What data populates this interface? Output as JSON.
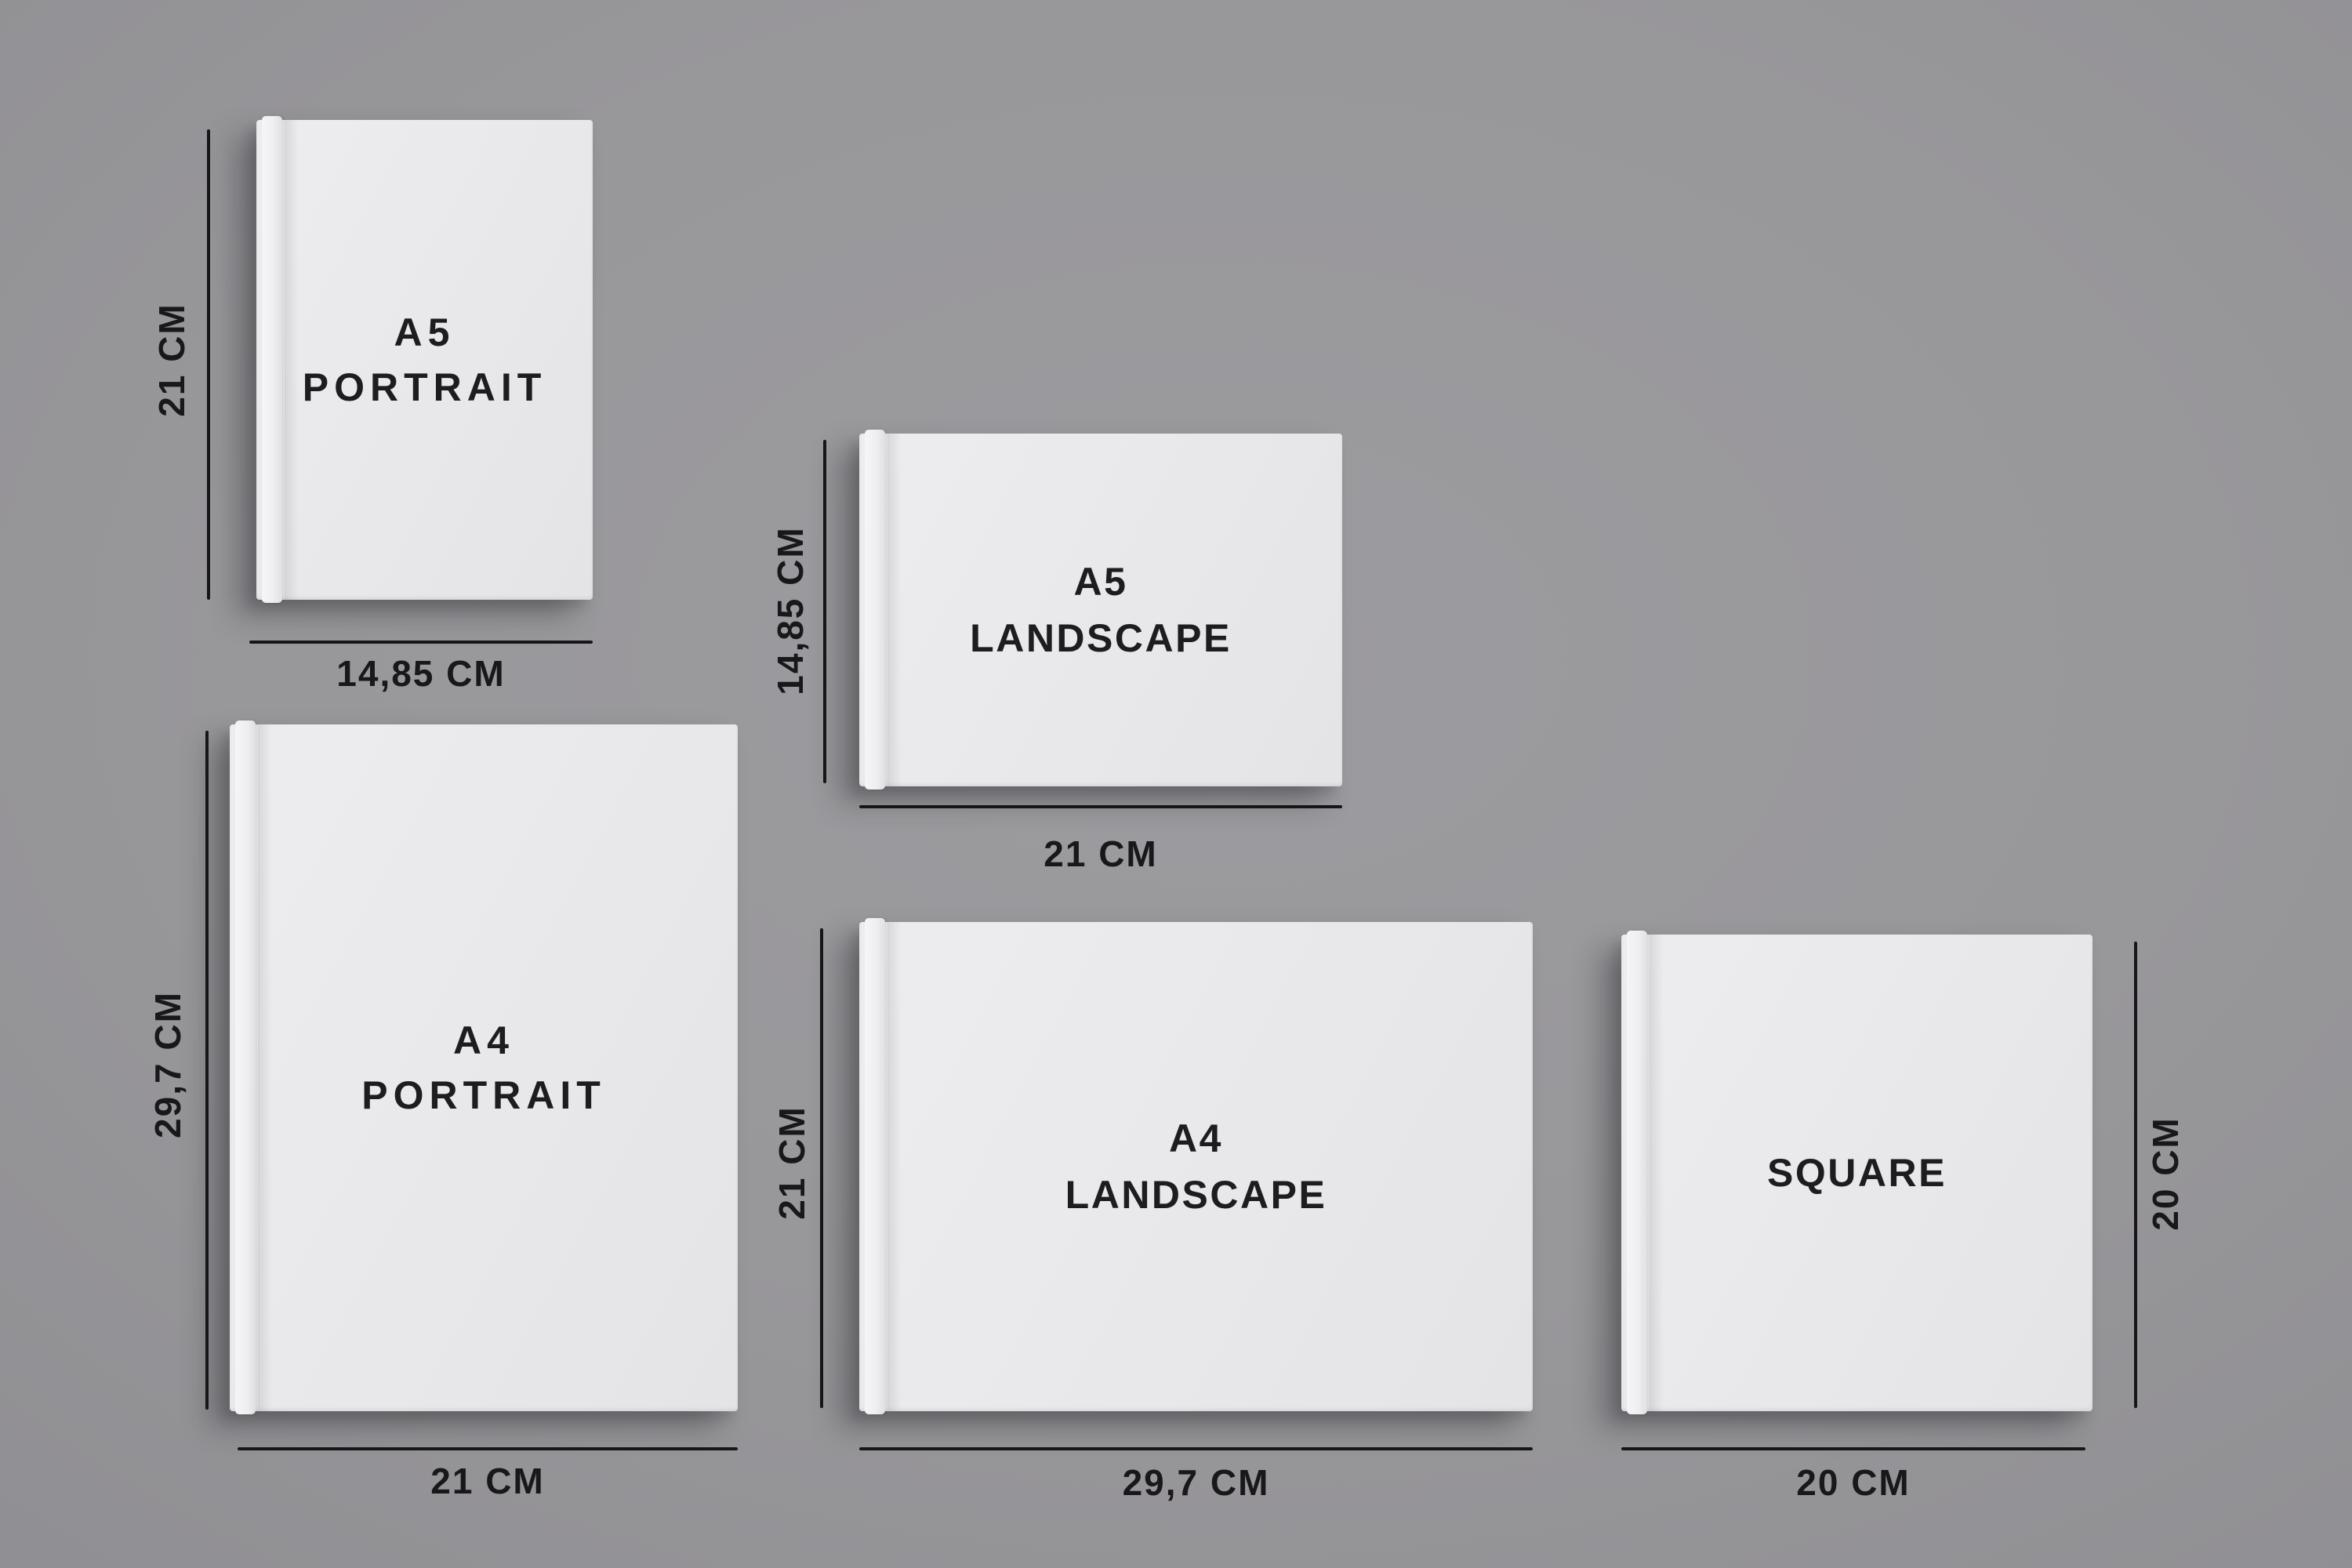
{
  "colors": {
    "background": "#98979a",
    "book_cover": "#e9e9eb",
    "spine_highlight": "#f5f5f7",
    "dimension_line": "#161618",
    "text": "#1d1d1f"
  },
  "books": [
    {
      "name": "A5 Portrait",
      "line1": "A5",
      "line2": "PORTRAIT",
      "height_label": "21 CM",
      "width_label": "14,85 CM"
    },
    {
      "name": "A5 Landscape",
      "line1": "A5",
      "line2": "LANDSCAPE",
      "height_label": "14,85 CM",
      "width_label": "21 CM"
    },
    {
      "name": "A4 Portrait",
      "line1": "A4",
      "line2": "PORTRAIT",
      "height_label": "29,7 CM",
      "width_label": "21 CM"
    },
    {
      "name": "A4 Landscape",
      "line1": "A4",
      "line2": "LANDSCAPE",
      "height_label": "21 CM",
      "width_label": "29,7 CM"
    },
    {
      "name": "Square",
      "line1": "SQUARE",
      "height_label": "20 CM",
      "width_label": "20 CM"
    }
  ]
}
